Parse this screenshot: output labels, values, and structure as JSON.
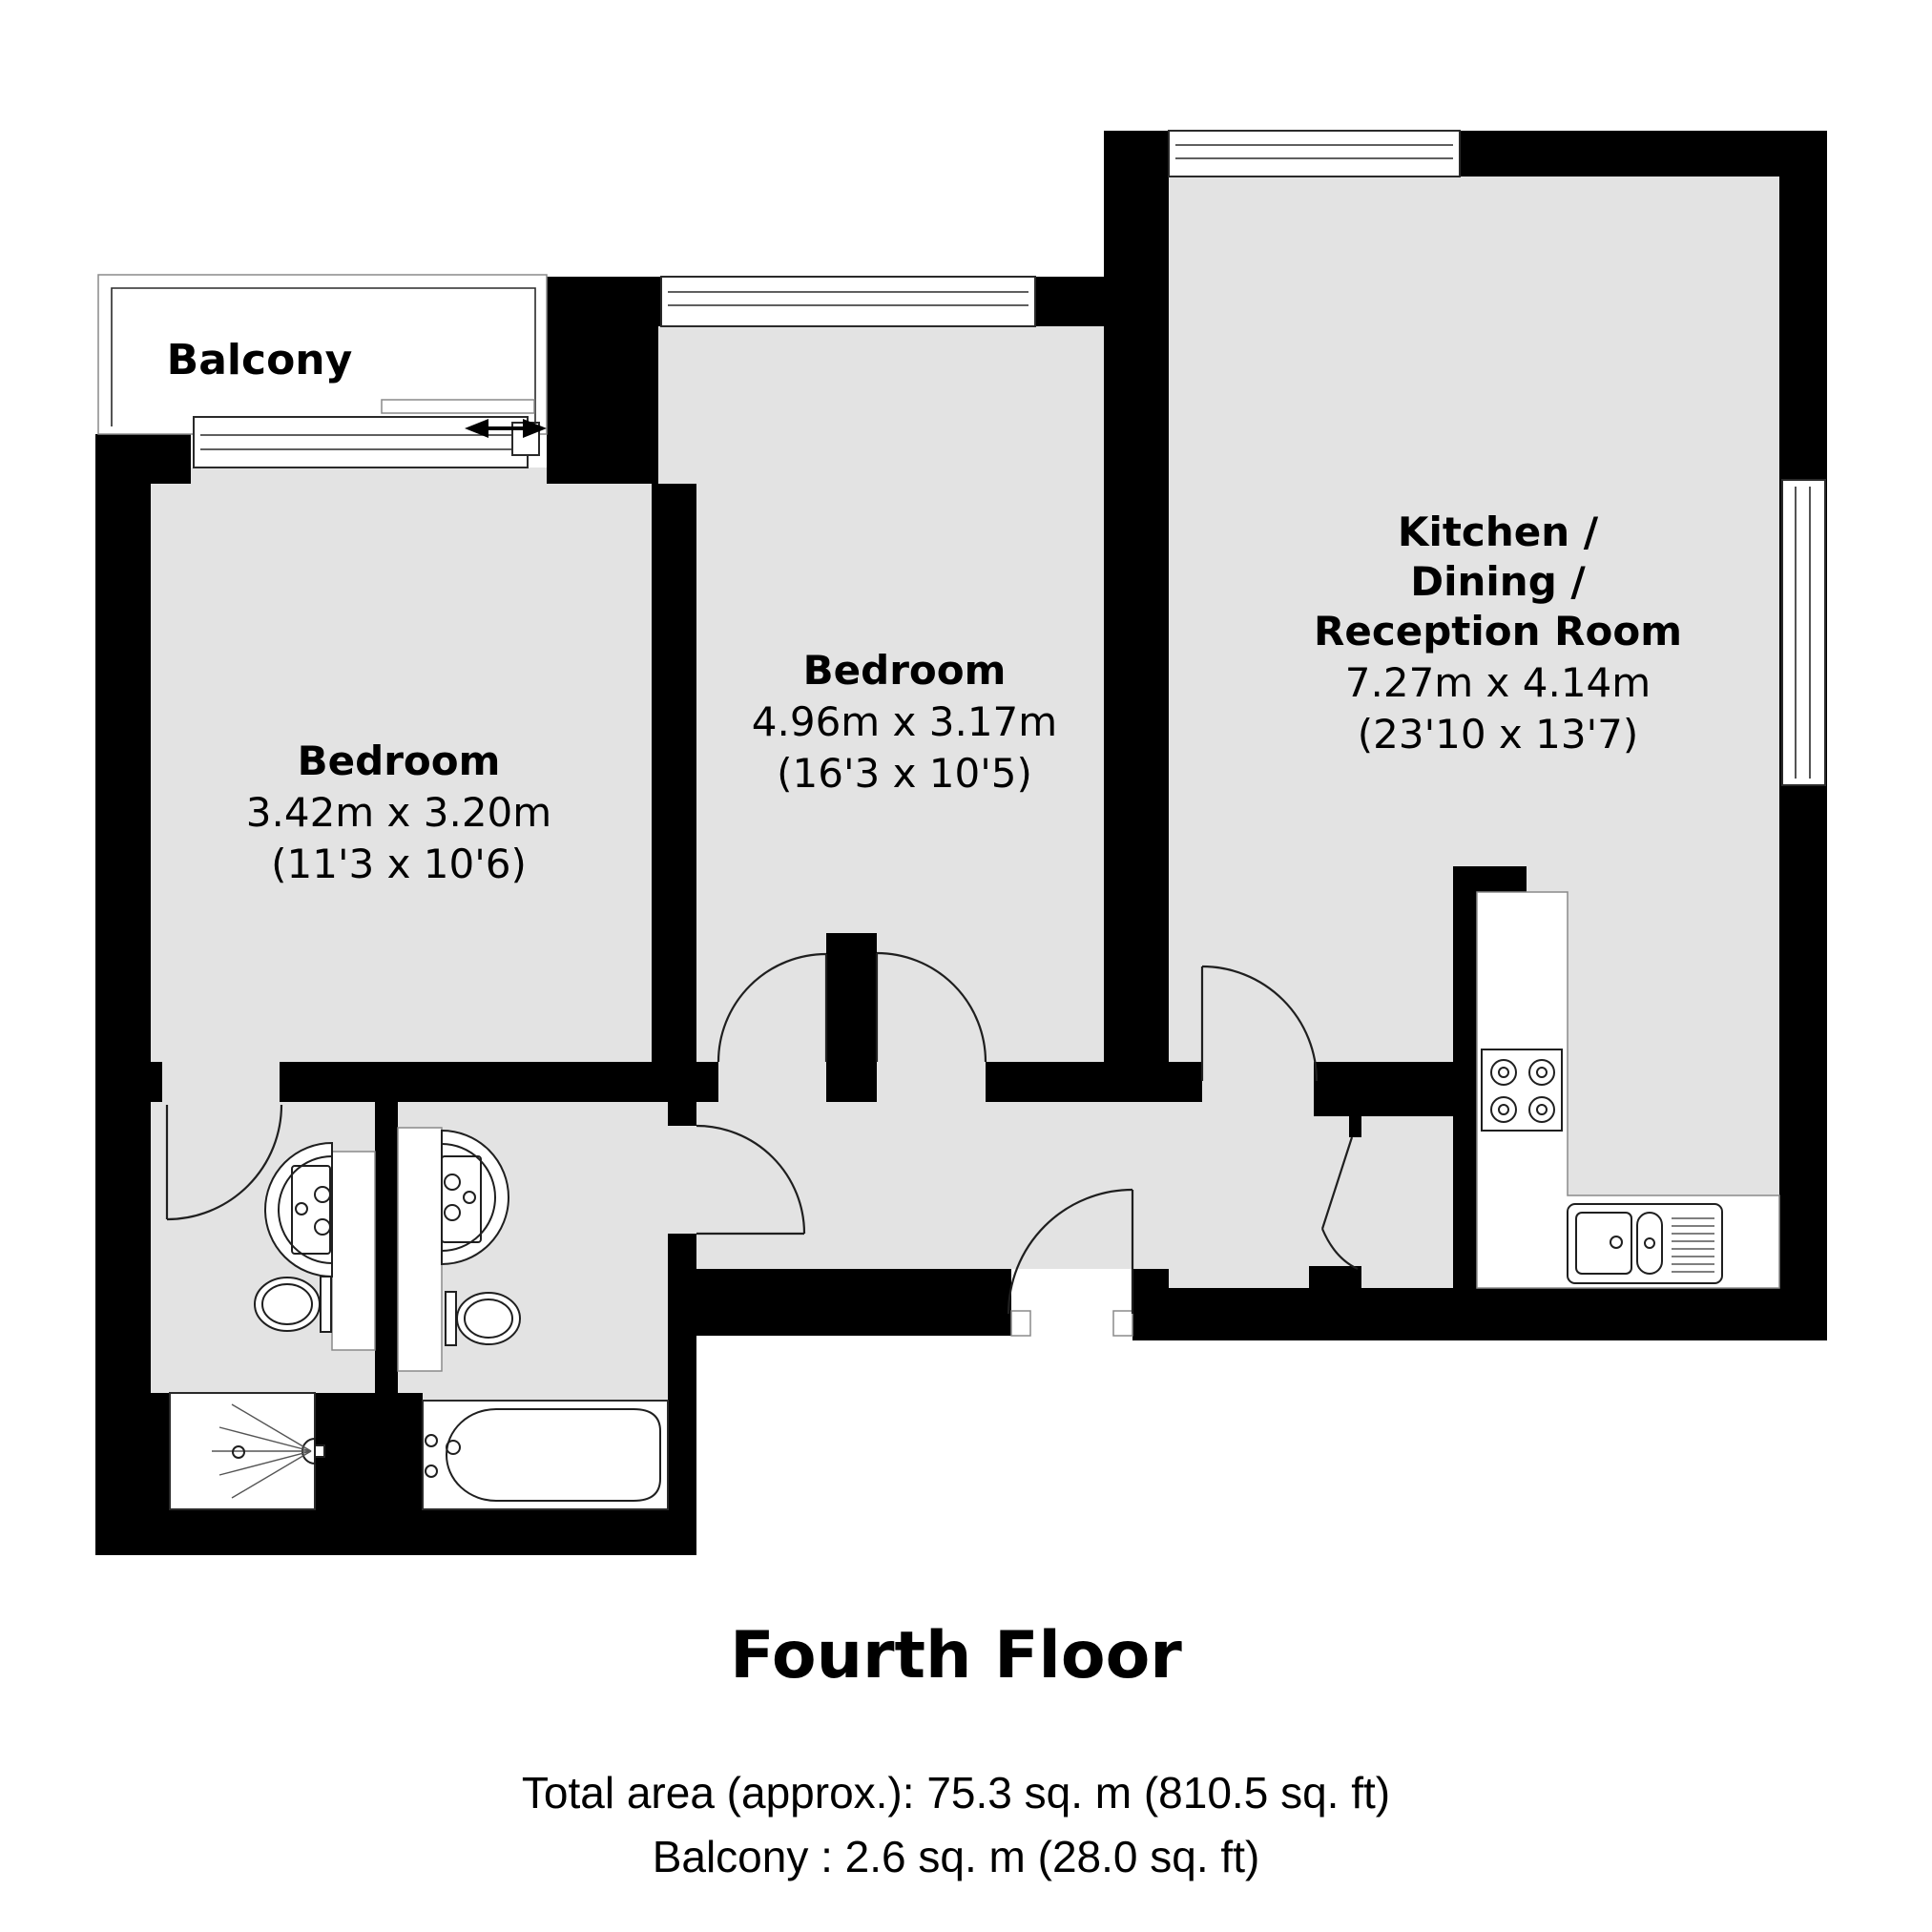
{
  "plan": {
    "balcony_label": "Balcony",
    "rooms": [
      {
        "id": "bedroom-1",
        "name": "Bedroom",
        "dims_m": "3.42m x 3.20m",
        "dims_ft": "(11'3 x 10'6)"
      },
      {
        "id": "bedroom-2",
        "name": "Bedroom",
        "dims_m": "4.96m x 3.17m",
        "dims_ft": "(16'3 x 10'5)"
      },
      {
        "id": "kitchen-dining-reception",
        "name_line1": "Kitchen /",
        "name_line2": "Dining /",
        "name_line3": "Reception Room",
        "dims_m": "7.27m x 4.14m",
        "dims_ft": "(23'10 x 13'7)"
      }
    ],
    "fixtures": [
      "washbasin",
      "toilet",
      "shower",
      "bathtub",
      "hob",
      "kitchen-sink",
      "sliding-balcony-door",
      "windows",
      "door-swings"
    ]
  },
  "footer": {
    "title": "Fourth Floor",
    "total_area": "Total area (approx.): 75.3 sq. m (810.5 sq. ft)",
    "balcony_area": "Balcony : 2.6 sq. m (28.0 sq. ft)"
  },
  "colors": {
    "wall": "#000000",
    "floor": "#e3e3e3",
    "background": "#ffffff",
    "line": "#1f1f1f"
  }
}
